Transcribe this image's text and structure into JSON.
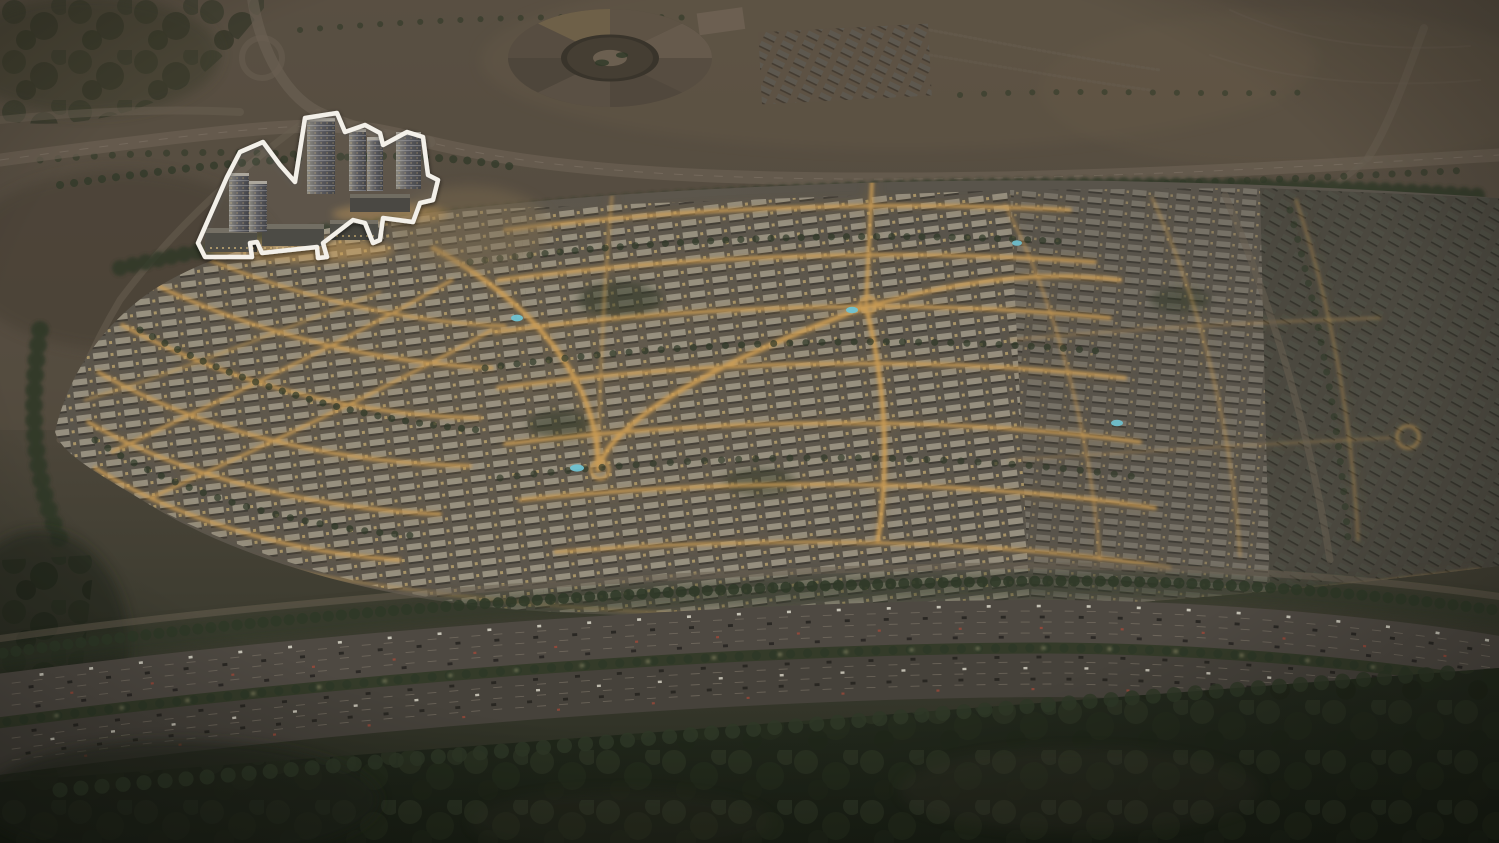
{
  "scene": {
    "type": "aerial-dusk-render",
    "subject": "master-planned villa community at dusk with one plot highlighted by a white outline",
    "visible_text": "none"
  },
  "highlighted_plot": {
    "position": "upper-left",
    "outline_color": "#f3f0e9",
    "tower_count": 6,
    "podium_block_count": 4
  },
  "landmarks": {
    "circular_structure": "star-shaped building, top centre",
    "highway_lanes_direction": "diagonal, lower third",
    "pool_count": 5,
    "roundabout_count": 3
  },
  "palette": {
    "desert": "#584e42",
    "desert-dark": "#453e30",
    "desert-light": "#6c5e4b",
    "vegetation-dark": "#313827",
    "tree": "#2e3827",
    "tree-deep": "#20281a",
    "community-base": "#59544b",
    "rooftop": "#a39c8a",
    "rooftop-dim": "#7b766b",
    "rooftop-dark": "#5d5a52",
    "street-glow": "#cf9f55",
    "street-glow-dim": "#87693a",
    "window-light": "#e9c87d",
    "road": "#695f52",
    "highway-a": "#4e4942",
    "highway-b": "#46423b",
    "lane-line": "#94897a",
    "median-green": "#343b29",
    "pool": "#6fc3d2",
    "outline": "#f3f0e9",
    "tower-face": "#8a877d",
    "tower-side": "#393a3e",
    "tower-roof": "#aaa59a",
    "foreground-a": "#242a1e",
    "foreground-b": "#1a2015",
    "sand-glow": "#7d6c50",
    "car-light": "#dcd8ca",
    "car-dark": "#24221f",
    "car-red": "#a14a3a"
  }
}
